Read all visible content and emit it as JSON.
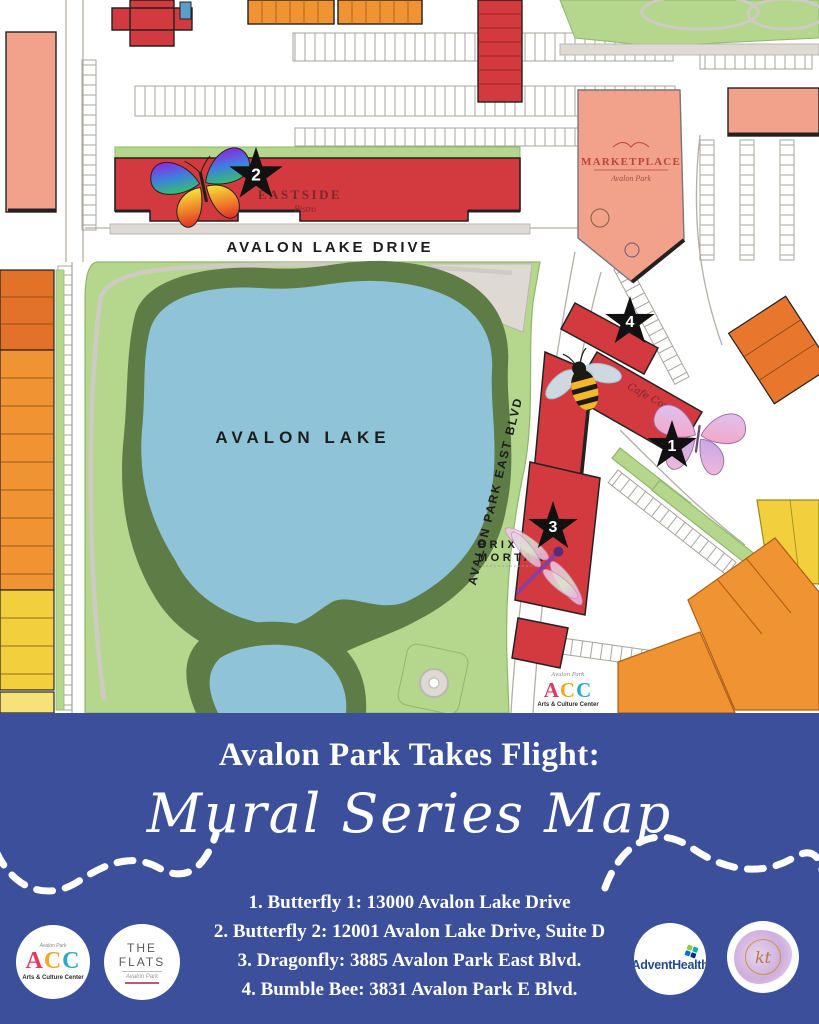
{
  "colors": {
    "footer_blue": "#3C4F9B",
    "building_red": "#D23A3F",
    "building_salmon": "#F2A18A",
    "building_orange": "#F09333",
    "building_dark_orange": "#E2712A",
    "building_yellow": "#F2CF3C",
    "lake_blue": "#8FC3D8",
    "park_green": "#B5D68D",
    "canopy_green": "#5E7C45",
    "marker_black": "#111111"
  },
  "map": {
    "street_labels": {
      "avalon_lake_drive": "AVALON LAKE DRIVE",
      "avalon_park_east_blvd": "AVALON PARK EAST BLVD"
    },
    "lake_label": "AVALON LAKE",
    "places": {
      "eastside": {
        "name": "EASTSIDE",
        "sub": "Bistro"
      },
      "marketplace": {
        "name": "MARKETPLACE",
        "sub": "Avalon Park"
      },
      "brix_line1": "BRIX &",
      "brix_line2": "MORTAR",
      "cafe_script": "Cafe Cozi",
      "acc": {
        "letters": [
          "A",
          "C",
          "C"
        ],
        "sub": "Arts & Culture Center",
        "script": "Avalon Park"
      }
    },
    "markers": [
      {
        "label": "1",
        "icon": "pink-butterfly-icon"
      },
      {
        "label": "2",
        "icon": "rainbow-butterfly-icon"
      },
      {
        "label": "3",
        "icon": "dragonfly-icon"
      },
      {
        "label": "4",
        "icon": "bumble-bee-icon"
      }
    ]
  },
  "footer": {
    "title": "Avalon Park Takes Flight:",
    "script_title": "Mural Series Map",
    "locations": [
      "1. Butterfly 1: 13000 Avalon Lake Drive",
      "2. Butterfly 2: 12001 Avalon Lake Drive, Suite D",
      "3. Dragonfly: 3885 Avalon Park East Blvd.",
      "4. Bumble Bee: 3831 Avalon Park E Blvd."
    ],
    "logos": {
      "acc": {
        "letters": [
          "A",
          "C",
          "C"
        ],
        "name": "Arts & Culture Center",
        "script": "Avalon Park"
      },
      "flats": {
        "name": "THE FLATS",
        "sub": "Avalon Park"
      },
      "advent": {
        "name": "AdventHealth"
      },
      "kt": {
        "abbr": "kt"
      }
    }
  }
}
